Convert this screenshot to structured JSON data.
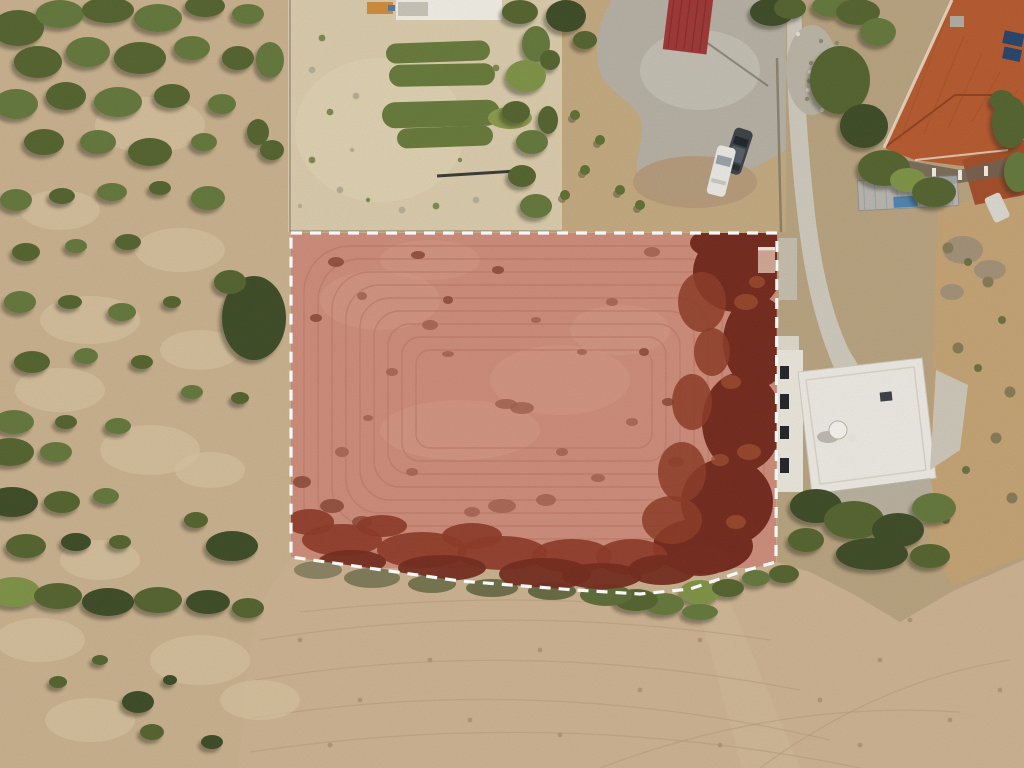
{
  "scene": {
    "title": "Aerial drone orthophoto of a land parcel highlighted with a red overlay and white dashed boundary",
    "type": "aerial-drone-photo",
    "annotations": {
      "parcel": {
        "label": "highlighted-parcel",
        "outline_style": "white dashed boundary",
        "fill_description": "semi-transparent red overlay on ploughed earth",
        "polygon_px": [
          [
            291,
            233
          ],
          [
            777,
            233
          ],
          [
            776,
            562
          ],
          [
            740,
            572
          ],
          [
            690,
            589
          ],
          [
            640,
            594
          ],
          [
            575,
            590
          ],
          [
            460,
            581
          ],
          [
            291,
            557
          ]
        ]
      }
    },
    "landmarks": [
      {
        "name": "olive-scrubland",
        "position": "left"
      },
      {
        "name": "vegetable-garden-with-crop-rows",
        "position": "top-center"
      },
      {
        "name": "red-roof-shed",
        "position": "top-center"
      },
      {
        "name": "parked-cars",
        "count": 2,
        "position": "top-center-right"
      },
      {
        "name": "terracotta-roof-house-with-solar-panels",
        "position": "top-right"
      },
      {
        "name": "concrete-driveway",
        "position": "right"
      },
      {
        "name": "white-flat-roof-building-with-solar-heater",
        "position": "right-middle"
      },
      {
        "name": "harvested-dry-field",
        "position": "bottom"
      }
    ]
  },
  "colors": {
    "boundary": "#ffffff",
    "parcel_overlay": "#cd8b79",
    "parcel_plow_line": "#bd7a67",
    "parcel_tree_dark": "#74291c",
    "parcel_tree_mid": "#8d3b26",
    "parcel_tree_light": "#a2502f",
    "parcel_shrub_band": "#8e3827",
    "parcel_shrub_dark": "#742b1e",
    "parcel_patch_light": "#d59a86",
    "blotch_a": "#a2604e",
    "blotch_b": "#8c4a3a",
    "scrub_ground": "#c8b08d",
    "scrub_patch": "#d5c29e",
    "garden_sand": "#d9caaa",
    "garden_sand_light": "#e0d3b4",
    "dry_grass": "#c2a87e",
    "road_concrete": "#b5afa3",
    "road_concrete_light": "#c6c0b4",
    "road_dirt": "#b49878",
    "shed_roof": "#9e3634",
    "shed_ridge": "#7c2a28",
    "car_dark": "#3c4148",
    "car_white": "#e9e8e3",
    "house_roof": "#b5592e",
    "house_roof_dark": "#a34d28",
    "house_ridge": "#8d3d1f",
    "house_eave": "#ead9c4",
    "solar_panel": "#274468",
    "white_building": "#ece9e2",
    "driveway": "#cdc8bb",
    "rubble": "#b9b3a5",
    "field_gold": "#cbb190",
    "field_line": "#b69b77",
    "slope_gold": "#c3a273",
    "crop_row": "#66793a",
    "bush_palette": [
      "#3d4c28",
      "#52632f",
      "#64773a",
      "#7d9245"
    ]
  }
}
